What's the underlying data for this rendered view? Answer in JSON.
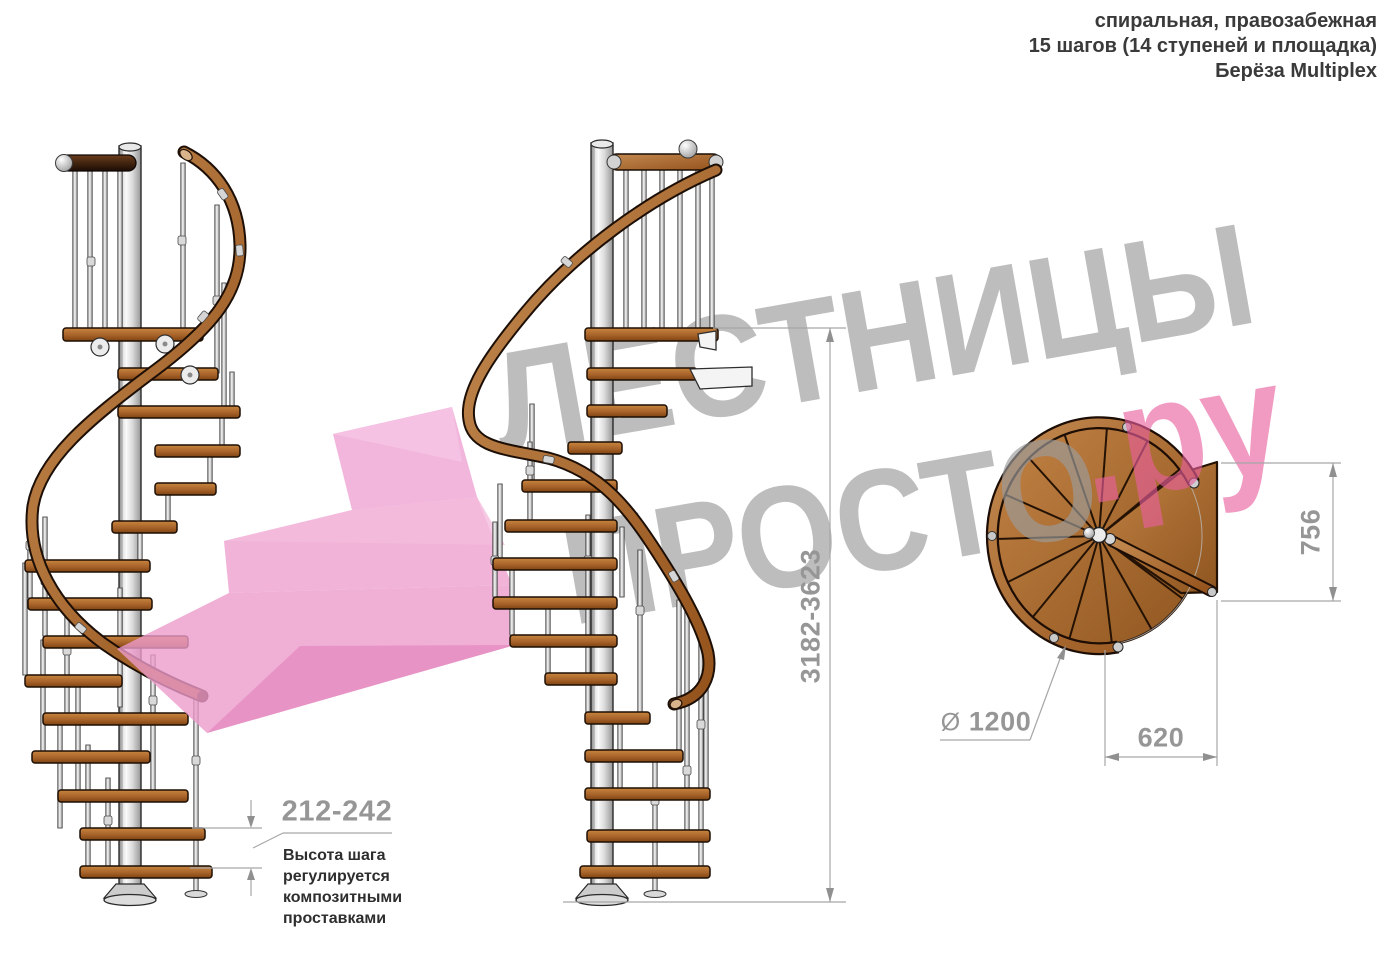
{
  "header": {
    "line1": "спиральная, правозабежная",
    "line2": "15 шагов (14 ступеней и площадка)",
    "line3": "Берёза Multiplex"
  },
  "watermark": {
    "word_top": "ЛЕСТНИЦЫ",
    "word_bottom": "ПРОСТО",
    "word_domain": ".ру"
  },
  "dimensions": {
    "total_height": "3182-3623",
    "step_height": "212-242",
    "landing_depth": "756",
    "landing_width": "620",
    "diameter_symbol": "Ø",
    "diameter_value": "1200",
    "step_note_lines": [
      "Высота шага",
      "регулируется",
      "композитными",
      "проставками"
    ]
  },
  "colors": {
    "wood": "#a8632a",
    "handrail": "#a95f26",
    "metal_pole": "#e8e8e8",
    "watermark_gray": "#9c9c9c",
    "watermark_pink": "#ea5f9f",
    "dimension_gray": "#969696"
  }
}
